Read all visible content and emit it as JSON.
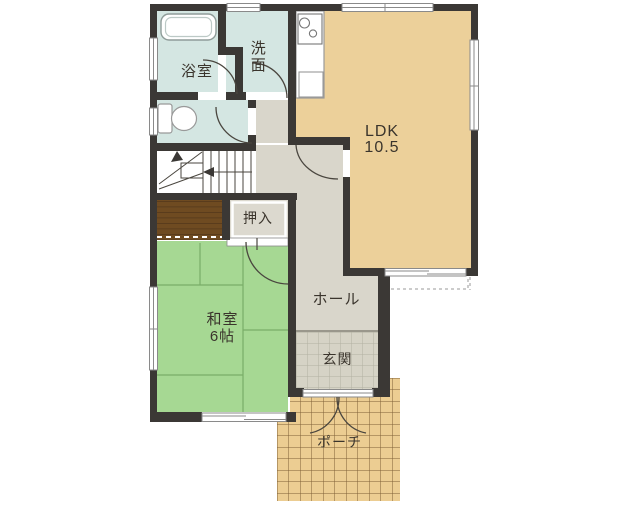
{
  "title": "1F floor plan",
  "colors": {
    "wall": "#3b3835",
    "wet_room": "#d4e6e2",
    "ldk": "#ecd09a",
    "tatami": "#a6d893",
    "hall": "#d9d6cb",
    "genkan_tile": "#d6d3c6",
    "closet": "#dcd9cf",
    "porch": "#eccd92",
    "under_stairs": "#6f4b21",
    "text": "#3a342c"
  },
  "rooms": {
    "bathroom": {
      "label": "浴室"
    },
    "washroom": {
      "label": "洗面"
    },
    "ldk": {
      "label": "LDK",
      "size": "10.5"
    },
    "closet": {
      "label": "押入"
    },
    "washitsu": {
      "label": "和室",
      "size": "6帖"
    },
    "hall": {
      "label": "ホール"
    },
    "genkan": {
      "label": "玄関"
    },
    "porch": {
      "label": "ポーチ"
    }
  }
}
